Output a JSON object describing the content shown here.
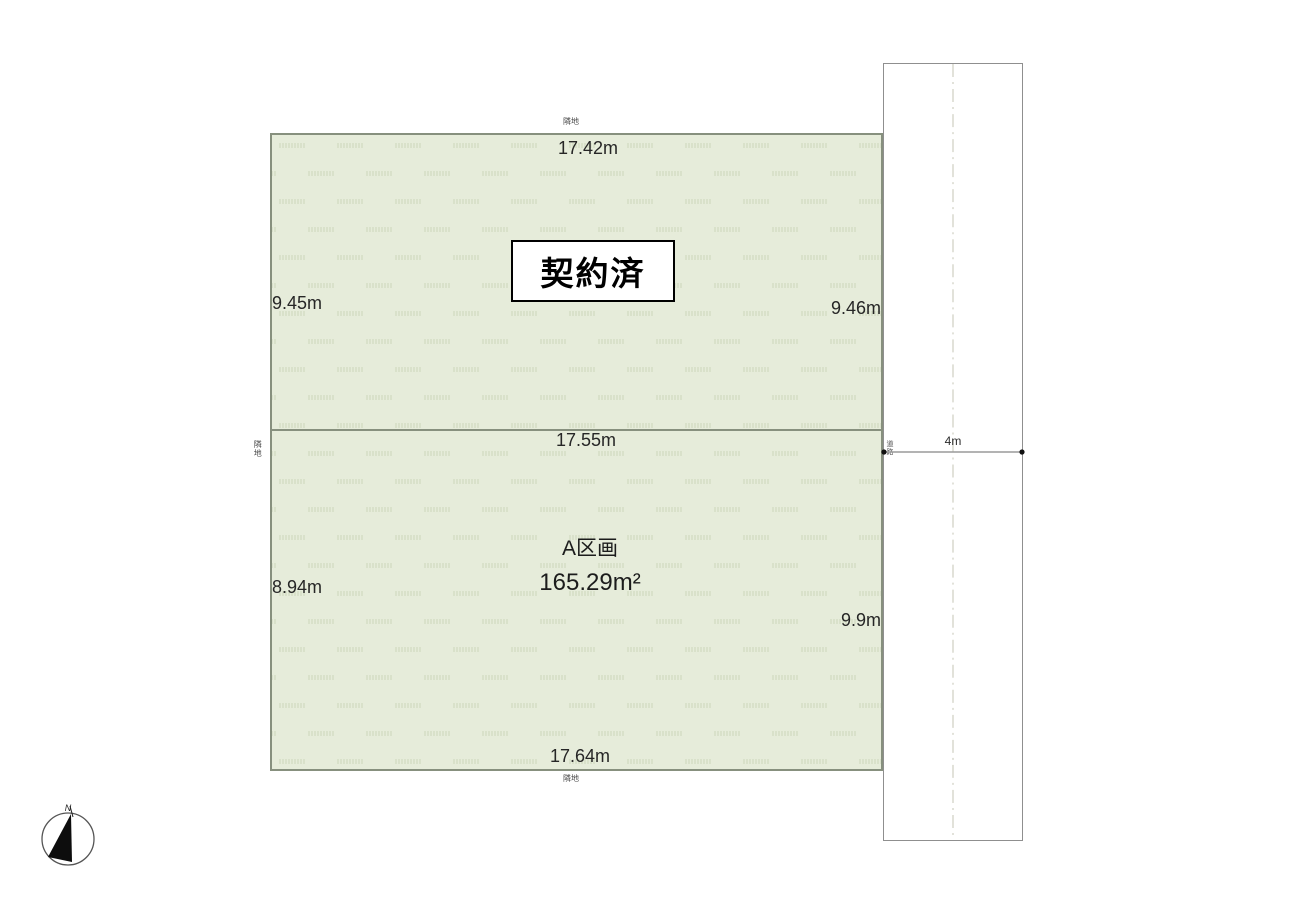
{
  "diagram": {
    "type": "land-plot-diagram",
    "plot_top": {
      "status_label": "契約済",
      "dim_top": "17.42m",
      "dim_left": "9.45m",
      "dim_right": "9.46m"
    },
    "plot_bottom": {
      "name": "A区画",
      "area": "165.29m²",
      "dim_top": "17.55m",
      "dim_left": "8.94m",
      "dim_right": "9.9m",
      "dim_bottom": "17.64m"
    },
    "road": {
      "width_label": "4m",
      "side_label": "道路"
    },
    "adjacent_labels": {
      "top": "隣地",
      "left": "隣地",
      "bottom": "隣地"
    },
    "compass": {
      "north_label": "N"
    },
    "colors": {
      "plot_fill": "#e6ecda",
      "plot_pattern_marks": "#ccd6ba",
      "plot_border": "#87907e",
      "road_border": "#8f8f8f",
      "road_centerline": "#d9d9cf",
      "dimension_line": "#9a9a9a",
      "text": "#1f1f1f"
    }
  }
}
